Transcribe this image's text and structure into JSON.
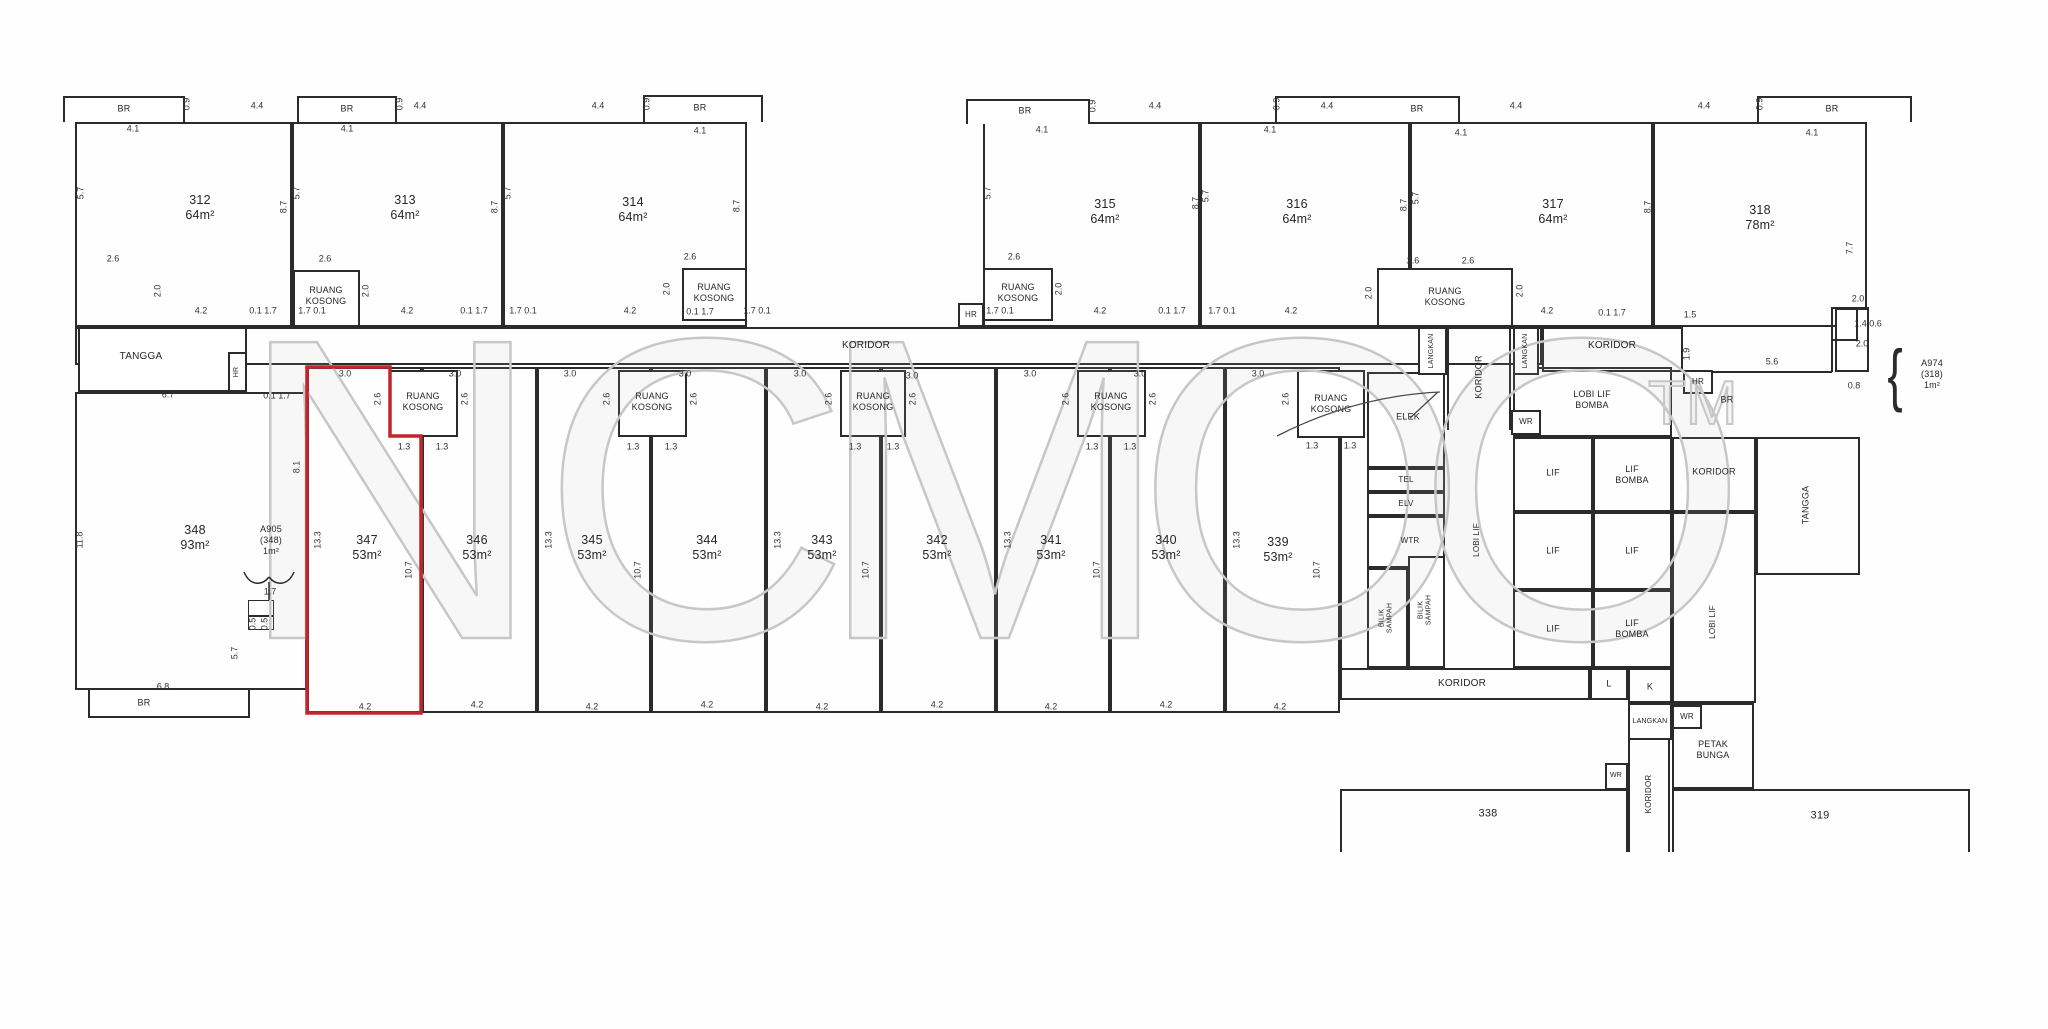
{
  "palette": {
    "ink": "#262626",
    "wall": "#2b2b2b",
    "highlight": "#c2262c",
    "watermark": "#c7c7c7",
    "paper": "#ffffff"
  },
  "watermark": {
    "letters": [
      "N",
      "C",
      "M",
      "O",
      "O"
    ],
    "tm_mark": "TM"
  },
  "units_top": [
    {
      "label": "312\n64m²"
    },
    {
      "label": "313\n64m²"
    },
    {
      "label": "314\n64m²"
    },
    {
      "label": "315\n64m²"
    },
    {
      "label": "316\n64m²"
    },
    {
      "label": "317\n64m²"
    },
    {
      "label": "318\n78m²"
    }
  ],
  "units_bottom": [
    {
      "label": "347\n53m²",
      "highlighted": true
    },
    {
      "label": "346\n53m²"
    },
    {
      "label": "345\n53m²"
    },
    {
      "label": "344\n53m²"
    },
    {
      "label": "343\n53m²"
    },
    {
      "label": "342\n53m²"
    },
    {
      "label": "341\n53m²"
    },
    {
      "label": "340\n53m²"
    },
    {
      "label": "339\n53m²"
    }
  ],
  "unit_348": {
    "label": "348\n93m²"
  },
  "units_lower": {
    "u338": "338",
    "u319": "319"
  },
  "rooms": {
    "ruang_kosong": "RUANG\nKOSONG",
    "koridor": "KORIDOR",
    "tangga": "TANGGA",
    "elek": "ELEK",
    "tel": "TEL",
    "elv": "ELV",
    "wtr": "WTR",
    "bilik_sampah": "BILIK\nSAMPAH",
    "langkan": "LANGKAN",
    "lobi_lif": "LOBI LIF",
    "lobi_lif_bomba": "LOBI LIF\nBOMBA",
    "lif": "LIF",
    "lif_bomba": "LIF\nBOMBA",
    "petak_bunga": "PETAK\nBUNGA",
    "l": "L",
    "k": "K",
    "wr": "WR",
    "hr": "HR",
    "br": "BR"
  },
  "callouts": {
    "a905": "A905\n(348)\n1m²",
    "a974": "A974\n(318)\n1m²",
    "brace": "{"
  },
  "dims": {
    "v01_17": "0.1 1.7",
    "v17_01": "1.7 0.1",
    "v09": "0.9",
    "v41": "4.1",
    "v44": "4.4",
    "v57": "5.7",
    "v87": "8.7",
    "v77": "7.7",
    "v42": "4.2",
    "v26": "2.6",
    "v20": "2.0",
    "v30": "3.0",
    "v133": "13.3",
    "v107": "10.7",
    "v13": "1.3",
    "v118": "11.8",
    "v67": "6.7",
    "v68": "6.8",
    "v81": "8.1",
    "v17": "1.7",
    "v05": "0.5",
    "v15": "1.5",
    "v19": "1.9",
    "v56": "5.6",
    "v14_06": "1.4 0.6",
    "v08": "0.8"
  }
}
